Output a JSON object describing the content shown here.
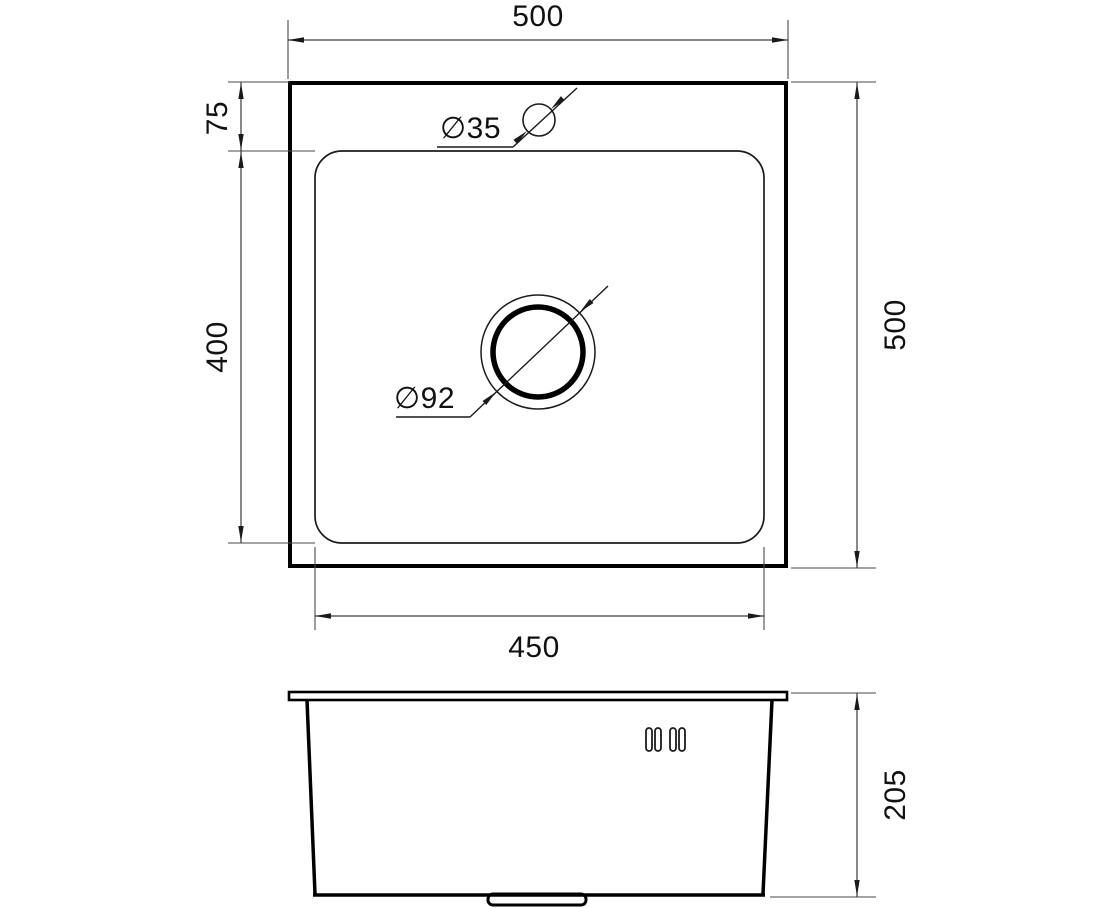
{
  "document": {
    "type": "technical-drawing",
    "subject": "kitchen-sink"
  },
  "views": {
    "top": {
      "overall_width_label": "500",
      "overall_depth_label": "500",
      "rim_offset_label": "75",
      "bowl_depth_label": "400",
      "bowl_width_label": "450",
      "faucet_hole_label": "∅35",
      "drain_hole_label": "∅92"
    },
    "side": {
      "height_label": "205"
    }
  },
  "dimensions_mm": {
    "overall_width": 500,
    "overall_depth": 500,
    "rim_to_bowl_offset": 75,
    "bowl_depth": 400,
    "bowl_width": 450,
    "faucet_hole_diameter": 35,
    "drain_hole_diameter": 92,
    "body_height": 205
  },
  "colors": {
    "background": "#ffffff",
    "geometry_line": "#000000",
    "dimension_line": "#3a3a3a",
    "text": "#111111"
  }
}
